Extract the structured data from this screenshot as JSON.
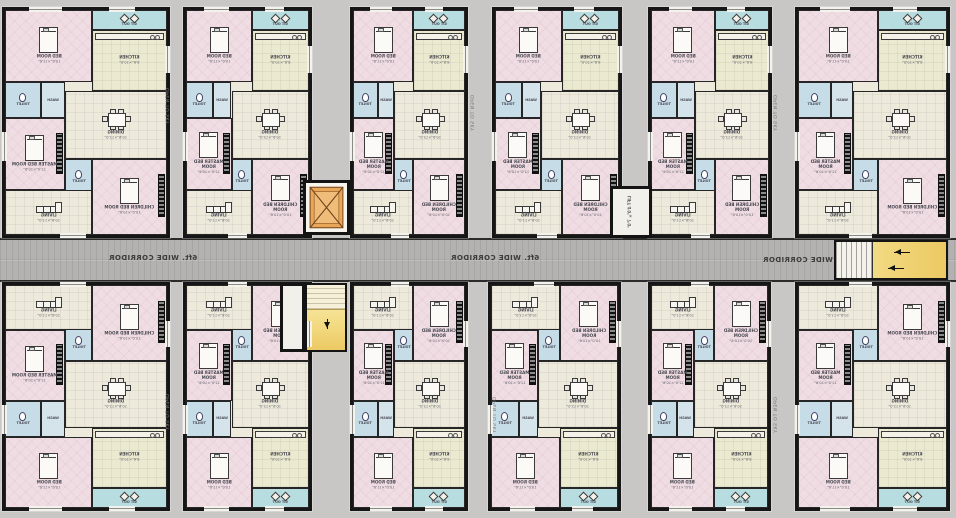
{
  "plan": {
    "width": 956,
    "height": 518,
    "kind": "apartment-floor-plan",
    "mirrored": true
  },
  "corridor": {
    "label": "6ft. WIDE CORRIDOR"
  },
  "labels": {
    "open_to_sky": "OPEN TO SKY",
    "lift": "LIFT",
    "lift_size": "4'0\"×7'0\""
  },
  "rooms": {
    "sitout": {
      "label": "SIT OUT",
      "size": "8'0\"×4'0\""
    },
    "bed": {
      "label": "BED ROOM",
      "size": "10'0\"×11'6\""
    },
    "kitchen": {
      "label": "KITCHEN",
      "size": "8'6\"×10'0\""
    },
    "toilet": {
      "label": "TOILET",
      "size": "4'6\"×7'0\""
    },
    "wash": {
      "label": "WASH",
      "size": ""
    },
    "dining": {
      "label": "DINING",
      "size": "10'6\"×12'0\""
    },
    "master": {
      "label": "MASTER BED ROOM",
      "size": "12'0\"×10'6\""
    },
    "children": {
      "label": "CHILDREN BED ROOM",
      "size": "10'0\"×10'6\""
    },
    "living": {
      "label": "LIVING",
      "size": "10'6\"×11'0\""
    }
  },
  "units": [
    {
      "row": "top",
      "x": 2,
      "w": 168
    },
    {
      "row": "top",
      "x": 183,
      "w": 129
    },
    {
      "row": "top",
      "x": 350,
      "w": 118
    },
    {
      "row": "top",
      "x": 492,
      "w": 130
    },
    {
      "row": "top",
      "x": 648,
      "w": 124
    },
    {
      "row": "top",
      "x": 795,
      "w": 155
    },
    {
      "row": "bottom",
      "x": 2,
      "w": 168
    },
    {
      "row": "bottom",
      "x": 183,
      "w": 129
    },
    {
      "row": "bottom",
      "x": 350,
      "w": 118
    },
    {
      "row": "bottom",
      "x": 488,
      "w": 133
    },
    {
      "row": "bottom",
      "x": 648,
      "w": 123
    },
    {
      "row": "bottom",
      "x": 795,
      "w": 155
    }
  ],
  "colors": {
    "background": "#c8c7c5",
    "corridor": "#b3b2b0",
    "wall": "#161616",
    "floor_cream": "#edeadb",
    "room_pink": "#f0dce3",
    "balcony_cyan": "#b7dde1",
    "kitchen_pale": "#ebe9cf",
    "toilet_blue": "#c6dde8",
    "stair_yellow": "#f1d77c",
    "lift_orange": "#e8a658"
  }
}
